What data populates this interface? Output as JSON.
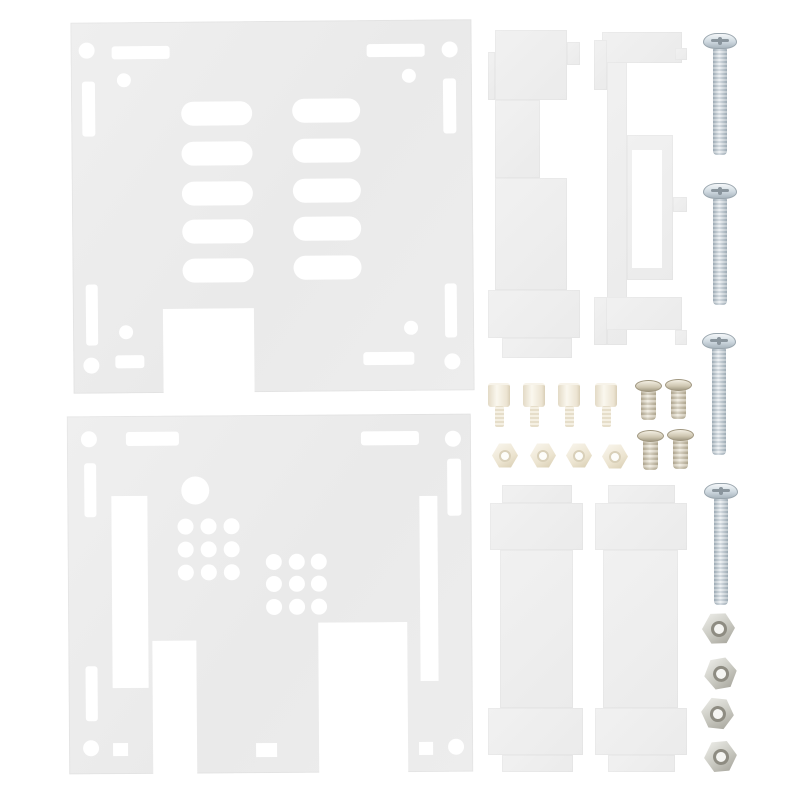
{
  "image": {
    "description": "Product photo of a clear acrylic enclosure case kit: top cover plate with vent slots, bottom base plate with hole grids, four laser-cut side panels, four zinc machine screws, four steel hex nuts, four white nylon standoffs, four white nylon nuts and four small pan-head screws on a white background",
    "background": "#ffffff"
  },
  "parts_list": [
    {
      "name": "top cover acrylic plate",
      "quantity": 1
    },
    {
      "name": "bottom base acrylic plate",
      "quantity": 1
    },
    {
      "name": "acrylic side panel",
      "quantity": 4
    },
    {
      "name": "zinc pan-head machine screw",
      "quantity": 4
    },
    {
      "name": "steel hex nut",
      "quantity": 4
    },
    {
      "name": "nylon standoff",
      "quantity": 4
    },
    {
      "name": "nylon hex nut",
      "quantity": 4
    },
    {
      "name": "small pan-head screw",
      "quantity": 4
    }
  ],
  "colors": {
    "bg": "#ffffff",
    "acrylic": "#ebebeb",
    "acrylic-light": "#f1f1f1",
    "zinc-mid": "#c5d0d8",
    "steel-mid": "#bcbcb4",
    "nylon-mid": "#efe7d4",
    "brass-mid": "#c9c1ac"
  },
  "scene": {
    "plates": [
      {
        "name": "top-cover-plate",
        "x": 72,
        "y": 21,
        "w": 401,
        "h": 371,
        "rotate": -0.5,
        "cutouts": [
          {
            "t": "c",
            "cx": 16,
            "cy": 28,
            "r": 8
          },
          {
            "t": "r",
            "x": 41,
            "y": 24,
            "w": 58,
            "h": 13,
            "rx": 3
          },
          {
            "t": "c",
            "cx": 53,
            "cy": 58,
            "r": 7
          },
          {
            "t": "r",
            "x": 11,
            "y": 59,
            "w": 13,
            "h": 55,
            "rx": 3
          },
          {
            "t": "c",
            "cx": 379,
            "cy": 30,
            "r": 8
          },
          {
            "t": "r",
            "x": 296,
            "y": 24,
            "w": 58,
            "h": 13,
            "rx": 3
          },
          {
            "t": "c",
            "cx": 338,
            "cy": 56,
            "r": 7
          },
          {
            "t": "r",
            "x": 372,
            "y": 59,
            "w": 13,
            "h": 55,
            "rx": 3
          },
          {
            "t": "r",
            "x": 110,
            "y": 80,
            "w": 71,
            "h": 24,
            "rx": 12
          },
          {
            "t": "r",
            "x": 110,
            "y": 120,
            "w": 71,
            "h": 24,
            "rx": 12
          },
          {
            "t": "r",
            "x": 110,
            "y": 160,
            "w": 71,
            "h": 24,
            "rx": 12
          },
          {
            "t": "r",
            "x": 110,
            "y": 198,
            "w": 71,
            "h": 24,
            "rx": 12
          },
          {
            "t": "r",
            "x": 110,
            "y": 237,
            "w": 71,
            "h": 24,
            "rx": 12
          },
          {
            "t": "r",
            "x": 221,
            "y": 78,
            "w": 68,
            "h": 24,
            "rx": 12
          },
          {
            "t": "r",
            "x": 221,
            "y": 118,
            "w": 68,
            "h": 24,
            "rx": 12
          },
          {
            "t": "r",
            "x": 221,
            "y": 158,
            "w": 68,
            "h": 24,
            "rx": 12
          },
          {
            "t": "r",
            "x": 221,
            "y": 196,
            "w": 68,
            "h": 24,
            "rx": 12
          },
          {
            "t": "r",
            "x": 221,
            "y": 235,
            "w": 68,
            "h": 24,
            "rx": 12
          },
          {
            "t": "r",
            "x": 13,
            "y": 262,
            "w": 12,
            "h": 61,
            "rx": 3
          },
          {
            "t": "c",
            "cx": 53,
            "cy": 310,
            "r": 7
          },
          {
            "t": "r",
            "x": 42,
            "y": 333,
            "w": 29,
            "h": 13,
            "rx": 3
          },
          {
            "t": "c",
            "cx": 18,
            "cy": 343,
            "r": 8
          },
          {
            "t": "r",
            "x": 372,
            "y": 264,
            "w": 12,
            "h": 54,
            "rx": 3
          },
          {
            "t": "c",
            "cx": 338,
            "cy": 308,
            "r": 7
          },
          {
            "t": "r",
            "x": 290,
            "y": 332,
            "w": 51,
            "h": 13,
            "rx": 3
          },
          {
            "t": "c",
            "cx": 379,
            "cy": 342,
            "r": 8
          },
          {
            "t": "r",
            "x": 90,
            "y": 287,
            "w": 91,
            "h": 86
          }
        ]
      },
      {
        "name": "bottom-base-plate",
        "x": 68,
        "y": 415,
        "w": 404,
        "h": 358,
        "rotate": -0.4,
        "cutouts": [
          {
            "t": "c",
            "cx": 22,
            "cy": 23,
            "r": 8
          },
          {
            "t": "r",
            "x": 59,
            "y": 16,
            "w": 53,
            "h": 14,
            "rx": 3
          },
          {
            "t": "r",
            "x": 17,
            "y": 47,
            "w": 12,
            "h": 54,
            "rx": 3
          },
          {
            "t": "r",
            "x": 294,
            "y": 17,
            "w": 58,
            "h": 14,
            "rx": 3
          },
          {
            "t": "c",
            "cx": 386,
            "cy": 25,
            "r": 8
          },
          {
            "t": "r",
            "x": 380,
            "y": 45,
            "w": 14,
            "h": 57,
            "rx": 3
          },
          {
            "t": "c",
            "cx": 128,
            "cy": 75,
            "r": 14
          },
          {
            "t": "g",
            "x0": 117.5,
            "y0": 110.5,
            "dx": 23,
            "dy": 23,
            "nx": 3,
            "ny": 3,
            "r": 8
          },
          {
            "t": "g",
            "x0": 206,
            "y0": 146.5,
            "dx": 22.5,
            "dy": 22.5,
            "nx": 3,
            "ny": 3,
            "r": 8
          },
          {
            "t": "r",
            "x": 44,
            "y": 80,
            "w": 36,
            "h": 192
          },
          {
            "t": "r",
            "x": 352,
            "y": 82,
            "w": 18,
            "h": 185
          },
          {
            "t": "r",
            "x": 84,
            "y": 225,
            "w": 44,
            "h": 134
          },
          {
            "t": "r",
            "x": 250,
            "y": 208,
            "w": 89,
            "h": 151
          },
          {
            "t": "r",
            "x": 17,
            "y": 250,
            "w": 12,
            "h": 55,
            "rx": 3
          },
          {
            "t": "c",
            "cx": 22,
            "cy": 332,
            "r": 8
          },
          {
            "t": "r",
            "x": 44,
            "y": 327,
            "w": 15,
            "h": 13
          },
          {
            "t": "r",
            "x": 187,
            "y": 328,
            "w": 21,
            "h": 14
          },
          {
            "t": "c",
            "cx": 387,
            "cy": 333,
            "r": 8
          },
          {
            "t": "r",
            "x": 350,
            "y": 328,
            "w": 14,
            "h": 13
          }
        ]
      }
    ],
    "side_panels": [
      {
        "name": "side-panel-top-left",
        "pieces": [
          [
            495,
            30,
            72,
            70
          ],
          [
            567,
            42,
            13,
            23
          ],
          [
            488,
            52,
            7,
            48
          ],
          [
            495,
            100,
            45,
            78
          ],
          [
            495,
            178,
            72,
            112
          ],
          [
            488,
            290,
            92,
            48
          ],
          [
            502,
            338,
            70,
            20
          ]
        ],
        "cuts": []
      },
      {
        "name": "side-panel-top-right",
        "pieces": [
          [
            607,
            32,
            20,
            313
          ],
          [
            602,
            32,
            80,
            31
          ],
          [
            594,
            40,
            13,
            50
          ],
          [
            675,
            48,
            12,
            12
          ],
          [
            627,
            135,
            46,
            145
          ],
          [
            673,
            197,
            14,
            15
          ],
          [
            602,
            297,
            80,
            33
          ],
          [
            594,
            297,
            13,
            48
          ],
          [
            675,
            330,
            12,
            15
          ]
        ],
        "cuts": [
          [
            632,
            150,
            30,
            118
          ]
        ]
      },
      {
        "name": "side-panel-bottom-left",
        "pieces": [
          [
            502,
            485,
            70,
            18
          ],
          [
            490,
            503,
            93,
            47
          ],
          [
            500,
            550,
            73,
            158
          ],
          [
            488,
            708,
            95,
            47
          ],
          [
            502,
            755,
            71,
            17
          ]
        ],
        "cuts": []
      },
      {
        "name": "side-panel-bottom-right",
        "pieces": [
          [
            608,
            485,
            67,
            18
          ],
          [
            595,
            503,
            92,
            47
          ],
          [
            603,
            550,
            75,
            158
          ],
          [
            595,
            708,
            92,
            47
          ],
          [
            608,
            755,
            67,
            17
          ]
        ],
        "cuts": []
      }
    ],
    "machine_screws": {
      "head": [
        34,
        16
      ],
      "shaft": [
        14,
        108
      ],
      "positions": [
        [
          703,
          33
        ],
        [
          703,
          183
        ],
        [
          702,
          333
        ],
        [
          704,
          483
        ]
      ]
    },
    "hex_nuts": {
      "size": [
        33,
        31
      ],
      "rotations": [
        -2,
        -10,
        6,
        -5
      ],
      "positions": [
        [
          702,
          613
        ],
        [
          704,
          658
        ],
        [
          701,
          698
        ],
        [
          704,
          741
        ]
      ]
    },
    "standoffs": {
      "body": [
        22,
        24
      ],
      "stud": [
        9,
        20
      ],
      "positions": [
        [
          488,
          383
        ],
        [
          523,
          383
        ],
        [
          558,
          383
        ],
        [
          595,
          383
        ]
      ]
    },
    "nylon_nuts": {
      "size": [
        26,
        25
      ],
      "positions": [
        [
          492,
          443
        ],
        [
          530,
          443
        ],
        [
          566,
          443
        ],
        [
          602,
          444
        ]
      ]
    },
    "small_screws": {
      "head": [
        27,
        12
      ],
      "shank": [
        15,
        30
      ],
      "positions": [
        [
          635,
          380
        ],
        [
          665,
          379
        ],
        [
          637,
          430
        ],
        [
          667,
          429
        ]
      ]
    }
  }
}
